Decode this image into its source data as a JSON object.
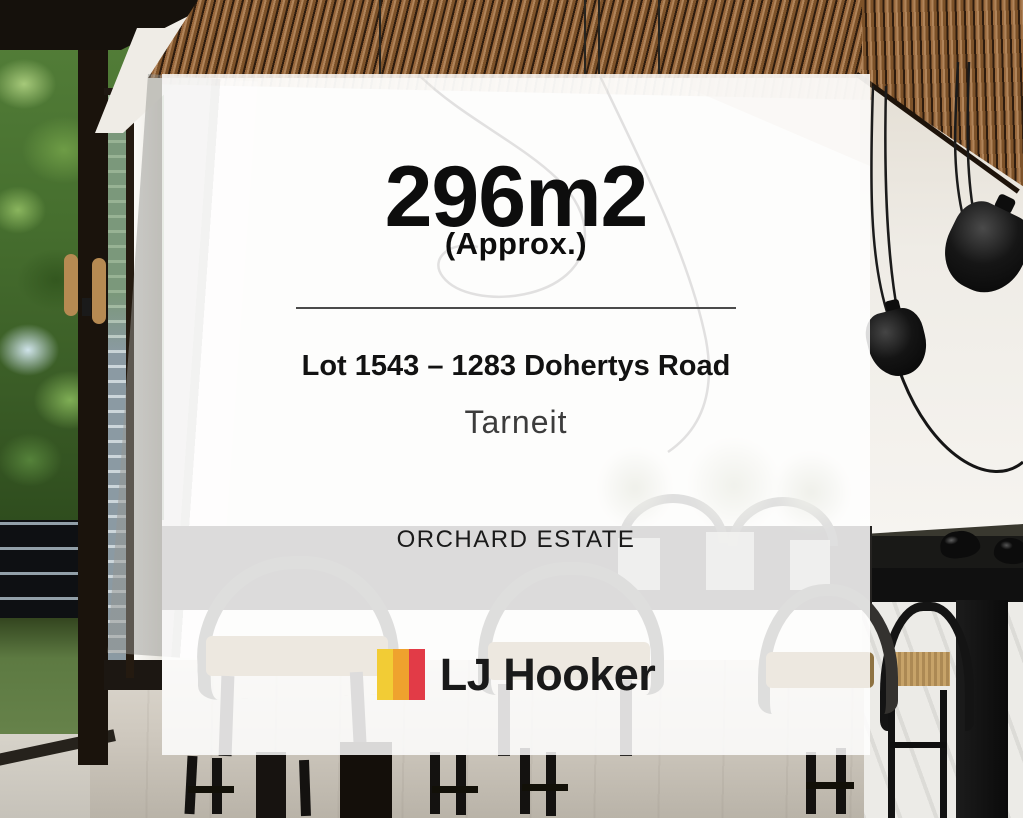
{
  "overlay_card": {
    "area_value": "296m2",
    "area_qualifier": "(Approx.)",
    "address_line": "Lot 1543 – 1283 Dohertys Road",
    "suburb": "Tarneit",
    "estate_name": "ORCHARD ESTATE"
  },
  "brand": {
    "name": "LJ Hooker",
    "logo_mark_colors": [
      "#F2CC35",
      "#EFA22E",
      "#E23B47"
    ]
  },
  "style": {
    "overlay_color": "rgba(255,255,255,0.84)"
  }
}
